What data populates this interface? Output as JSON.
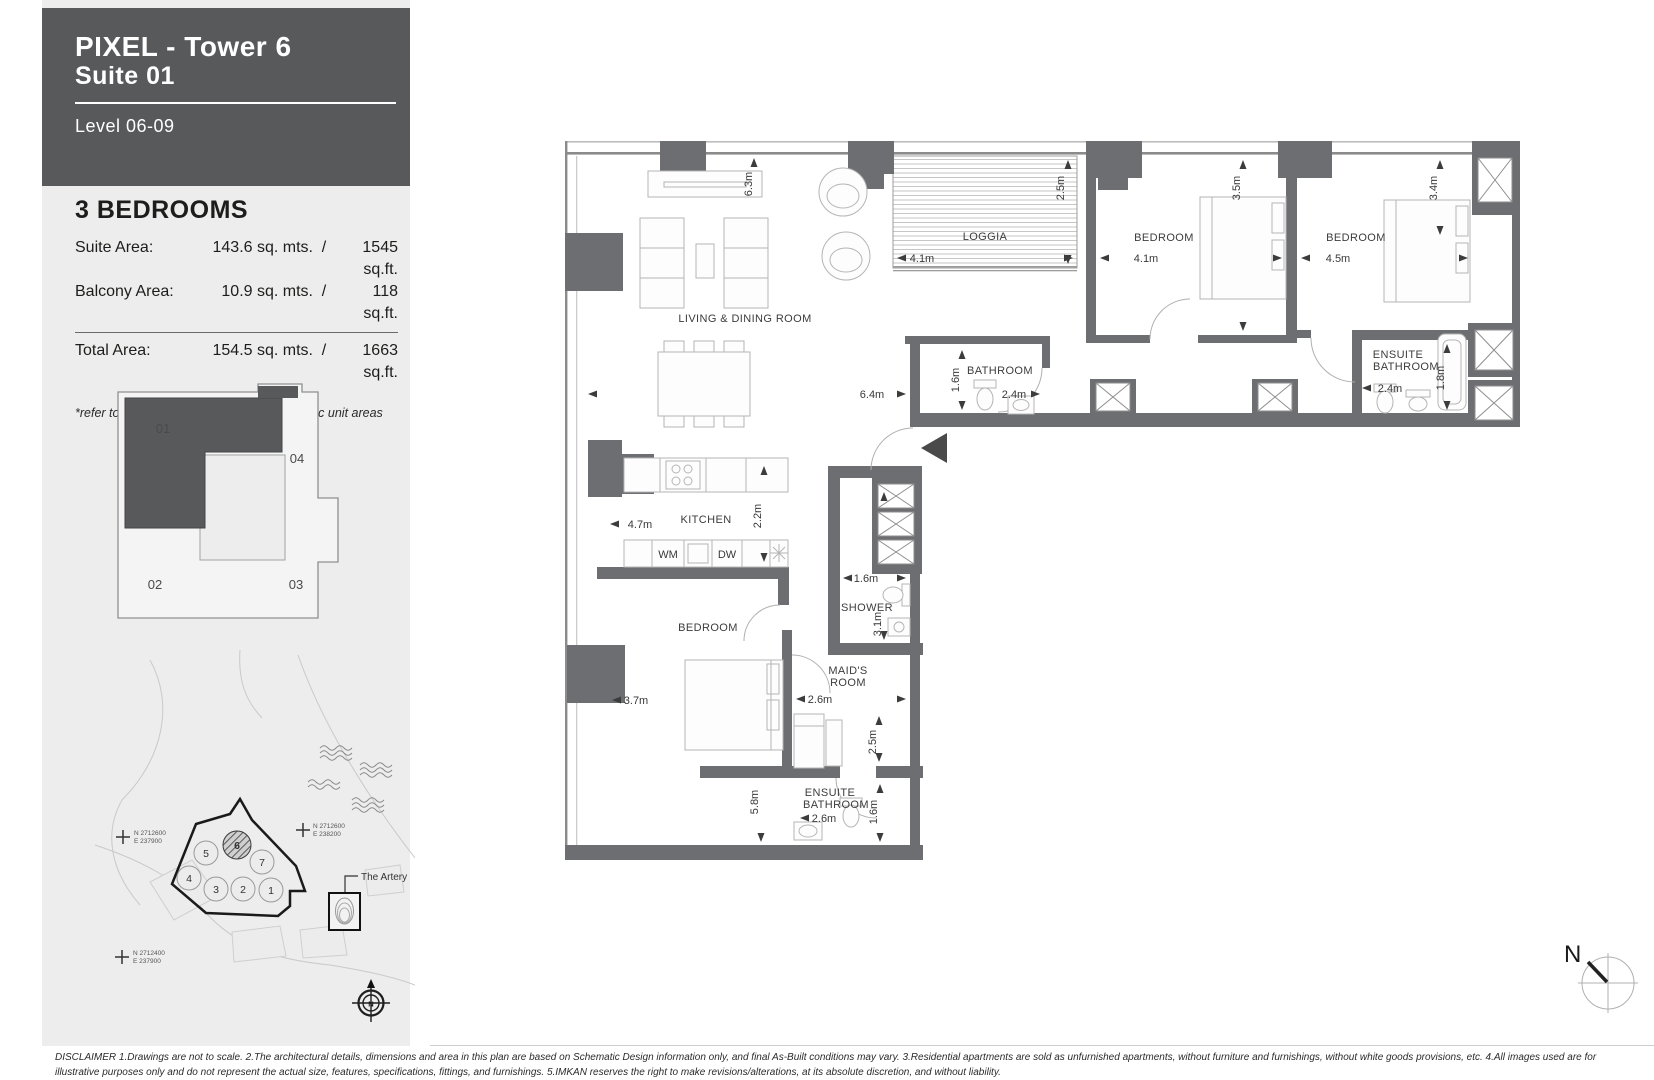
{
  "colors": {
    "wall": "#6d6e71",
    "header_bg": "#58595b",
    "sidebar_bg": "#ededee",
    "highlight": "#58595b"
  },
  "sidebar": {
    "header": {
      "title": "PIXEL - Tower 6",
      "subtitle": "Suite 01",
      "level": "Level 06-09"
    },
    "unit": {
      "heading": "3 BEDROOMS",
      "rows": [
        {
          "label": "Suite Area:",
          "metric": "143.6 sq. mts.",
          "slash": "/",
          "imperial": "1545 sq.ft."
        },
        {
          "label": "Balcony Area:",
          "metric": "10.9 sq. mts.",
          "slash": "/",
          "imperial": "118 sq.ft."
        }
      ],
      "total": {
        "label": "Total Area:",
        "metric": "154.5 sq. mts.",
        "slash": "/",
        "imperial": "1663 sq.ft."
      },
      "note": "*refer to sales schedule for individual specific unit areas"
    },
    "key_plan": {
      "unit01": "01",
      "unit02": "02",
      "unit03": "03",
      "unit04": "04"
    },
    "site_map": {
      "buildings": {
        "b1": "1",
        "b2": "2",
        "b3": "3",
        "b4": "4",
        "b5": "5",
        "b6": "6",
        "b7": "7"
      },
      "artery": "The Artery",
      "marker_left": {
        "n": "N 2712600",
        "e": "E 237900"
      },
      "marker_right": {
        "n": "N 2712600",
        "e": "E 238200"
      },
      "marker_bottom": {
        "n": "N 2712400",
        "e": "E 237900"
      },
      "compass_n": "N"
    }
  },
  "floor_plan": {
    "rooms": {
      "living": "LIVING & DINING ROOM",
      "loggia": "LOGGIA",
      "bedroom1": "BEDROOM",
      "bedroom2": "BEDROOM",
      "bathroom": "BATHROOM",
      "ensuite1_l1": "ENSUITE",
      "ensuite1_l2": "BATHROOM",
      "kitchen": "KITCHEN",
      "bedroom3": "BEDROOM",
      "shower": "SHOWER",
      "maids_l1": "MAID'S",
      "maids_l2": "ROOM",
      "ensuite2_l1": "ENSUITE",
      "ensuite2_l2": "BATHROOM"
    },
    "dims": {
      "living_d": "6.3m",
      "living_w": "6.4m",
      "loggia_w": "4.1m",
      "loggia_d": "2.5m",
      "br1_w": "4.1m",
      "br1_d": "3.5m",
      "br2_w": "4.5m",
      "br2_d": "3.4m",
      "bath_d": "1.6m",
      "bath_w": "2.4m",
      "ens1_w": "2.4m",
      "ens1_d": "1.8m",
      "kitchen_w": "4.7m",
      "kitchen_d": "2.2m",
      "br3_w": "3.7m",
      "br3_h": "5.8m",
      "shower_w": "1.6m",
      "shower_d": "3.1m",
      "maids_w": "2.6m",
      "maids_d": "2.5m",
      "ens2_w": "2.6m",
      "ens2_d": "1.6m"
    },
    "appliances": {
      "wm": "WM",
      "dw": "DW"
    },
    "compass_n": "N"
  },
  "disclaimer": "DISCLAIMER 1.Drawings are not to scale. 2.The architectural details, dimensions and area in this plan are based on Schematic Design information only, and final As-Built conditions may vary. 3.Residential apartments are sold as unfurnished apartments, without furniture and furnishings, without white goods provisions, etc. 4.All images used are for illustrative purposes only and do not represent the actual size, features, specifications, fittings, and furnishings. 5.IMKAN reserves the right to make revisions/alterations, at its absolute discretion, and without liability."
}
